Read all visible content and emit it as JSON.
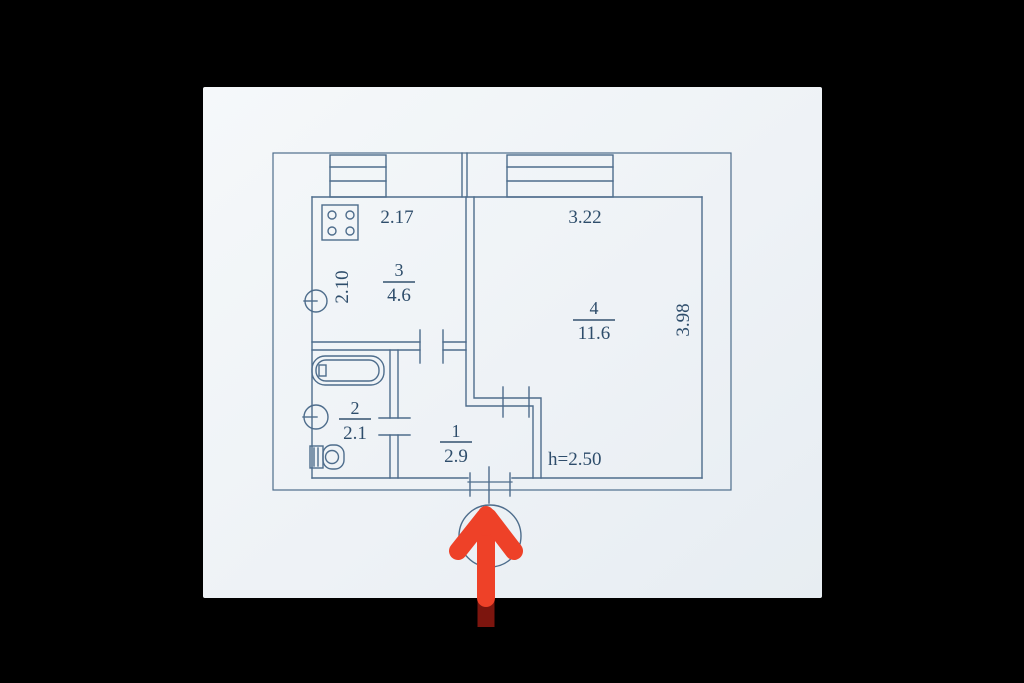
{
  "colors": {
    "background": "#000000",
    "paper": "#eef2f6",
    "line": "#4e6d8c",
    "text": "#2e4d6b",
    "arrow": "#ee4128",
    "arrow_dark": "#7c150e"
  },
  "plan": {
    "dim_top_kitchen": "2.17",
    "dim_top_room": "3.22",
    "dim_left_kitchen": "2.10",
    "dim_right_room": "3.98",
    "ceiling_height": "h=2.50",
    "rooms": {
      "hallway": {
        "number": "1",
        "area": "2.9"
      },
      "bathroom": {
        "number": "2",
        "area": "2.1"
      },
      "kitchen": {
        "number": "3",
        "area": "4.6"
      },
      "living_room": {
        "number": "4",
        "area": "11.6"
      }
    },
    "icons": {
      "stove": "stove-icon",
      "kitchen_sink": "kitchen-sink-icon",
      "bathtub": "bathtub-icon",
      "washbasin": "washbasin-icon",
      "toilet": "toilet-icon",
      "window_kitchen": "window-kitchen-icon",
      "window_living_room": "window-living-room-icon",
      "entrance_circle": "entrance-circle-icon",
      "entrance_arrow": "entrance-arrow-icon"
    }
  }
}
